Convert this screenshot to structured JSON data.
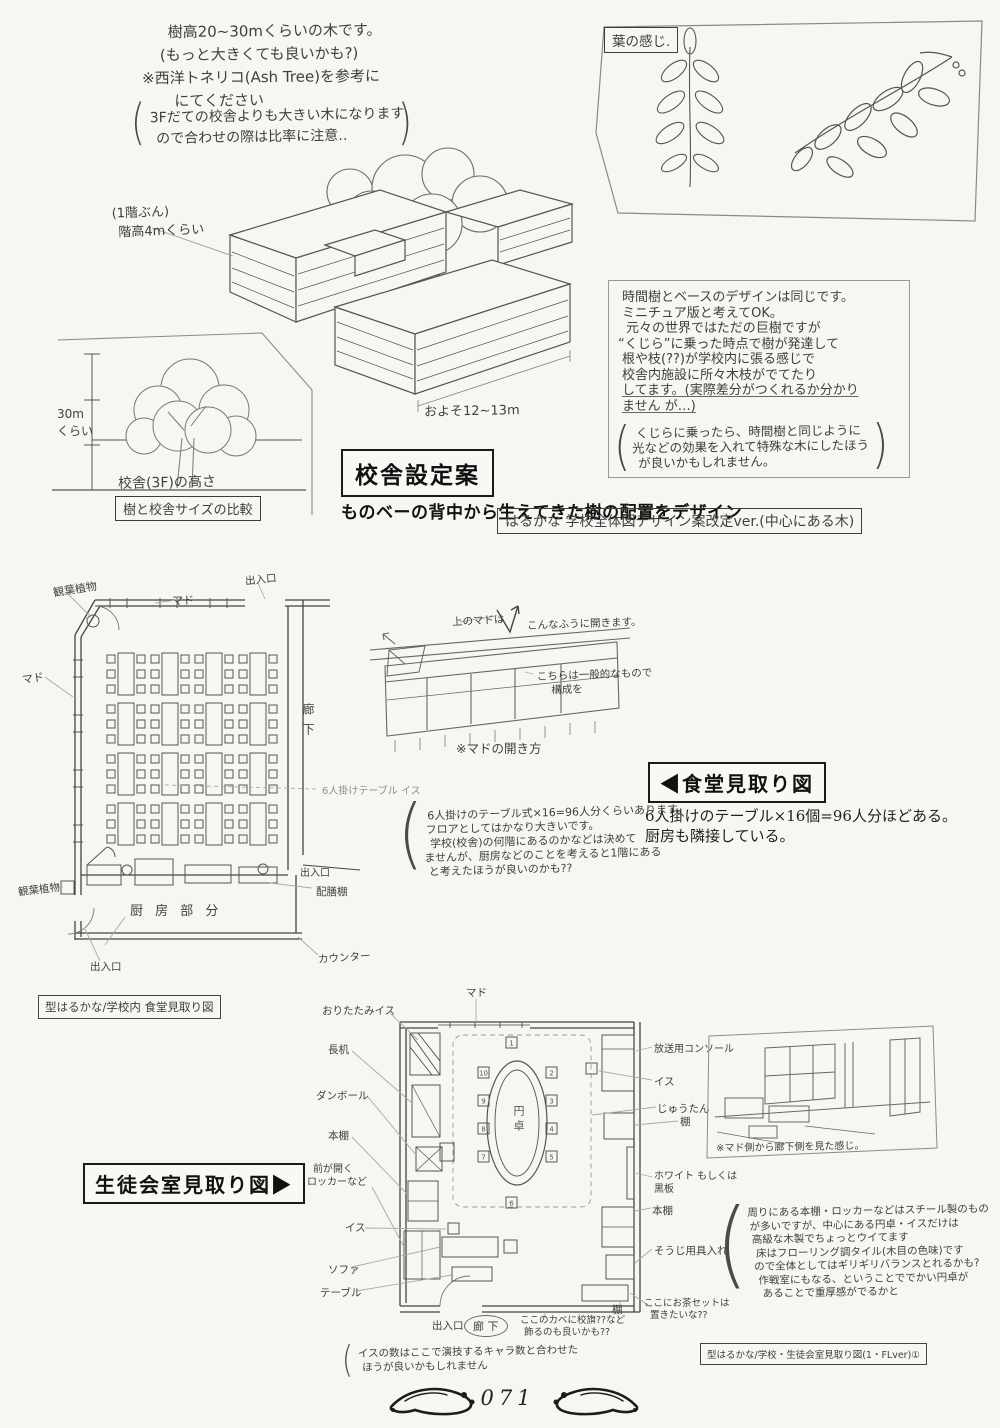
{
  "tree_note": {
    "l1": "樹高20~30mくらいの木です。",
    "l2": "(もっと大きくても良いかも?)",
    "l3": "※西洋トネリコ(Ash Tree)を参考に",
    "l4": "にてください",
    "p1": "3Fだての校舎よりも大きい木になります",
    "p2": "ので合わせの際は比率に注意‥",
    "paren_open": "(",
    "paren_close": ")"
  },
  "leaf_panel": {
    "title": "葉の感じ."
  },
  "building": {
    "floor_note_1": "(1階ぶん)",
    "floor_note_2": "階高4mくらい",
    "width_note": "およそ12~13m"
  },
  "tree_compare": {
    "dim_1": "30m",
    "dim_2": "くらい",
    "height_line": "校舎(3F)の高さ",
    "caption": "樹と校舎サイズの比較"
  },
  "design_note": {
    "l1": "時間樹とベースのデザインは同じです。",
    "l2": "ミニチュア版と考えてOK。",
    "l3": "元々の世界ではただの巨樹ですが",
    "l4": "“くじら”に乗った時点で樹が発達して",
    "l5": "根や枝(??)が学校内に張る感じで",
    "l6": "校舎内施設に所々木枝がでてたり",
    "l7": "してます。(実際差分がつくれるか分かり",
    "l8": "ません が…)",
    "p1": "くじらに乗ったら、時間樹と同じように",
    "p2": "光などの効果を入れて特殊な木にしたほう",
    "p3": "が良いかもしれません。",
    "paren_open": "(",
    "paren_close": ")"
  },
  "school_section": {
    "title": "校舎設定案",
    "caption": "ものベーの背中から生えてきた樹の配置をデザイン",
    "sub_label": "はるかな 学校全体図デザイン案改定ver.(中心にある木)"
  },
  "cafeteria": {
    "label_plant_top": "観葉植物",
    "label_window_top": "マド",
    "label_entrance_top": "出入口",
    "label_window_left": "マド",
    "label_corridor": "廊下",
    "label_table": "6人掛けテーブル イス",
    "label_entrance_right": "出入口",
    "label_serving_shelf": "配膳棚",
    "label_plant_bottom": "観葉植物",
    "label_kitchen": "厨 房 部 分",
    "label_entrance_bottom": "出入口",
    "label_counter": "カウンター",
    "caption_box": "型はるかな/学校内 食堂見取り図",
    "note_p1": "6人掛けのテーブル式×16=96人分くらいあります。",
    "note_p2": "フロアとしてはかなり大きいです。",
    "note_p3": "学校(校舎)の何階にあるのかなどは決めて",
    "note_p4": "ませんが、厨房などのことを考えると1階にある",
    "note_p5": "と考えたほうが良いのかも??",
    "paren_open": "("
  },
  "window_sketch": {
    "note_top_1": "上のマドは",
    "note_top_2": "こんなふうに開きます。",
    "note_right_1": "こちらは一般的なもので",
    "note_right_2": "構成を",
    "caption": "※マドの開き方"
  },
  "dining_section": {
    "title": "◀食堂見取り図",
    "caption_1": "6人掛けのテーブル×16個=96人分ほどある。",
    "caption_2": "厨房も隣接している。"
  },
  "council": {
    "title": "生徒会室見取り図▶",
    "label_window": "マド",
    "left_1": "おりたたみイス",
    "left_2": "長机",
    "left_3": "ダンボール",
    "left_4": "本棚",
    "left_5a": "前が開く",
    "left_5b": "ロッカーなど",
    "left_6": "イス",
    "left_7": "ソファ",
    "left_8": "テーブル",
    "right_1": "放送用コンソール",
    "right_2": "イス",
    "right_3": "じゅうたん",
    "right_4": "棚",
    "right_5a": "ホワイト もしくは",
    "right_5b": "黒板",
    "right_6": "本棚",
    "right_7": "そうじ用具入れ",
    "right_8": "棚",
    "table_label": "円卓",
    "seat_numbers": [
      "1",
      "2",
      "3",
      "4",
      "5",
      "6",
      "7",
      "8",
      "9",
      "10"
    ],
    "bottom_entrance": "出入口",
    "bottom_corridor": "廊 下",
    "bottom_note_1": "ここのカベに校旗??など",
    "bottom_note_2": "飾るのも良いかも??",
    "tea_note_1": "ここにお茶セットは",
    "tea_note_2": "置きたいな??",
    "chairs_note_1": "イスの数はここで演技するキャラ数と合わせた",
    "chairs_note_2": "ほうが良いかもしれません",
    "view_caption": "※マド側から廊下側を見た感じ。",
    "material_l1": "周りにある本棚・ロッカーなどはスチール製のもの",
    "material_l2": "が多いですが、中心にある円卓・イスだけは",
    "material_l3": "高級な木製でちょっとウイてます",
    "material_l4": "床はフローリング調タイル(木目の色味)です",
    "material_l5": "ので全体としてはギリギリバランスとれるかも?",
    "material_l6": "作戦室にもなる、ということででかい円卓が",
    "material_l7": "あることで重厚感がでるかと",
    "caption_box": "型はるかな/学校・生徒会室見取り図(1・FLver)①",
    "paren_open": "("
  },
  "footer": {
    "page_number": "071"
  }
}
